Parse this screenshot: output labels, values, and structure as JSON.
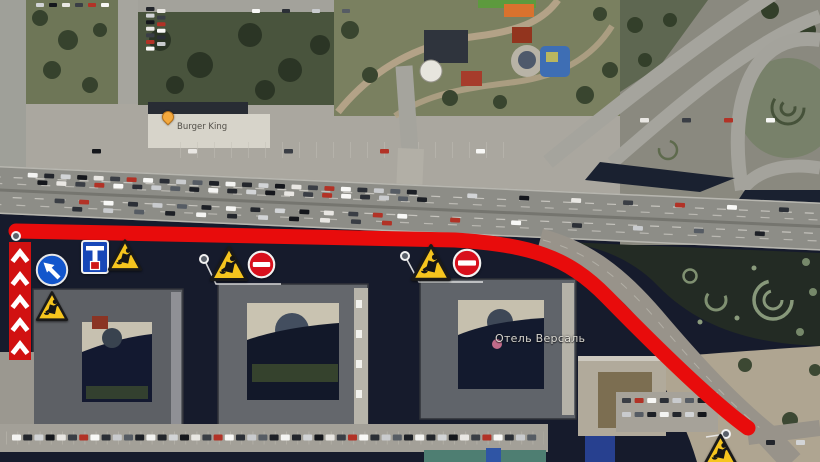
{
  "map": {
    "kind": "satellite-road-closure-plan",
    "place_labels": [
      {
        "text": "Отель Версаль",
        "x": 495,
        "y": 332,
        "style": "light"
      },
      {
        "text": "Burger King",
        "x": 177,
        "y": 122,
        "style": "dark"
      }
    ],
    "poi_pin": {
      "x": 162,
      "y": 111,
      "color": "#f4a93d"
    }
  },
  "annotations": {
    "route_color": "#e80c0c",
    "route_width": 15,
    "route_path": "M 16 231 L 455 240 C 530 245 567 256 607 297 C 652 343 712 402 748 428",
    "barrier": {
      "x": 9,
      "y": 242,
      "width": 22,
      "height": 118,
      "color": "#d11111",
      "chevrons": 5,
      "chevron_color": "#ffffff"
    },
    "signs": [
      {
        "type": "keep-left",
        "name": "keep-left-sign",
        "x": 35,
        "y": 253,
        "w": 34,
        "h": 34
      },
      {
        "type": "detour-scheme",
        "name": "detour-scheme-sign",
        "x": 81,
        "y": 240,
        "w": 28,
        "h": 34
      },
      {
        "type": "roadworks",
        "name": "roadworks-sign-1",
        "x": 107,
        "y": 238,
        "w": 36,
        "h": 35
      },
      {
        "type": "roadworks",
        "name": "roadworks-sign-2",
        "x": 35,
        "y": 290,
        "w": 34,
        "h": 33
      },
      {
        "type": "roadworks",
        "name": "roadworks-sign-3",
        "x": 209,
        "y": 245,
        "w": 40,
        "h": 38
      },
      {
        "type": "no-entry",
        "name": "no-entry-sign-1",
        "x": 247,
        "y": 250,
        "w": 29,
        "h": 29
      },
      {
        "type": "roadworks",
        "name": "roadworks-sign-4",
        "x": 410,
        "y": 243,
        "w": 42,
        "h": 40
      },
      {
        "type": "no-entry",
        "name": "no-entry-sign-2",
        "x": 452,
        "y": 248,
        "w": 30,
        "h": 30
      },
      {
        "type": "roadworks",
        "name": "roadworks-sign-5",
        "x": 702,
        "y": 433,
        "w": 37,
        "h": 35
      }
    ],
    "pins": [
      {
        "x": 16,
        "y": 236
      },
      {
        "x": 204,
        "y": 259
      },
      {
        "x": 405,
        "y": 256
      },
      {
        "x": 726,
        "y": 434
      }
    ],
    "leader_lines": [
      "M 204 259 L 216 284 L 281 284",
      "M 405 256 L 419 282 L 483 282",
      "M 726 434 L 706 437"
    ]
  },
  "scene": {
    "car_colors": [
      "#f4f4f2",
      "#23262c",
      "#d2d4d6",
      "#15171c",
      "#e9e7e3",
      "#3a3e45",
      "#b23226",
      "#f8f8f6",
      "#2b2f36",
      "#c9cbce",
      "#565c64",
      "#1d2026"
    ],
    "car_rows": [
      {
        "layer": "highway",
        "x": 28,
        "y": 171.5,
        "dx": 16.5,
        "n": 24,
        "w": 10,
        "h": 4.6,
        "seed": 0
      },
      {
        "layer": "highway",
        "x": 38,
        "y": 178.5,
        "dx": 19,
        "n": 21,
        "w": 10,
        "h": 4.6,
        "seed": 3
      },
      {
        "layer": "highway",
        "x": 56,
        "y": 196,
        "dx": 24.5,
        "n": 15,
        "w": 10,
        "h": 4.6,
        "seed": 5
      },
      {
        "layer": "highway",
        "x": 74,
        "y": 203.5,
        "dx": 31,
        "n": 11,
        "w": 10,
        "h": 4.6,
        "seed": 8
      },
      {
        "layer": "highway",
        "x": 468,
        "y": 172.5,
        "dx": 52,
        "n": 7,
        "w": 10,
        "h": 4.6,
        "seed": 2
      },
      {
        "layer": "highway",
        "x": 452,
        "y": 197.5,
        "dx": 61,
        "n": 6,
        "w": 10,
        "h": 4.6,
        "seed": 6
      },
      {
        "layer": "static",
        "x": 146,
        "y": 7,
        "dy": 6.6,
        "n": 7,
        "w": 8.5,
        "h": 4,
        "seed": 1
      },
      {
        "layer": "static",
        "x": 157,
        "y": 9,
        "dy": 6.6,
        "n": 6,
        "w": 8.5,
        "h": 4,
        "seed": 4
      },
      {
        "layer": "static",
        "x": 36,
        "y": 3,
        "dx": 13,
        "n": 6,
        "w": 8,
        "h": 4,
        "seed": 2
      },
      {
        "layer": "static",
        "x": 252,
        "y": 9,
        "dx": 30,
        "n": 4,
        "w": 8,
        "h": 4,
        "seed": 7
      },
      {
        "layer": "static",
        "x": 92,
        "y": 149,
        "dx": 96,
        "n": 5,
        "w": 9,
        "h": 4.5,
        "seed": 3
      },
      {
        "layer": "static",
        "x": 12,
        "y": 434.5,
        "dx": 11.2,
        "n": 47,
        "w": 9,
        "h": 6,
        "seed": 0
      },
      {
        "layer": "static",
        "x": 622,
        "y": 398,
        "dx": 12.6,
        "n": 7,
        "w": 9,
        "h": 5,
        "seed": 5
      },
      {
        "layer": "static",
        "x": 622,
        "y": 412,
        "dx": 12.6,
        "n": 7,
        "w": 9,
        "h": 5,
        "seed": 9
      },
      {
        "layer": "static",
        "x": 640,
        "y": 118,
        "dx": 42,
        "n": 4,
        "w": 9,
        "h": 4.5,
        "seed": 4
      },
      {
        "layer": "static",
        "x": 766,
        "y": 440,
        "dx": 30,
        "n": 2,
        "w": 9,
        "h": 5,
        "seed": 1
      }
    ]
  }
}
